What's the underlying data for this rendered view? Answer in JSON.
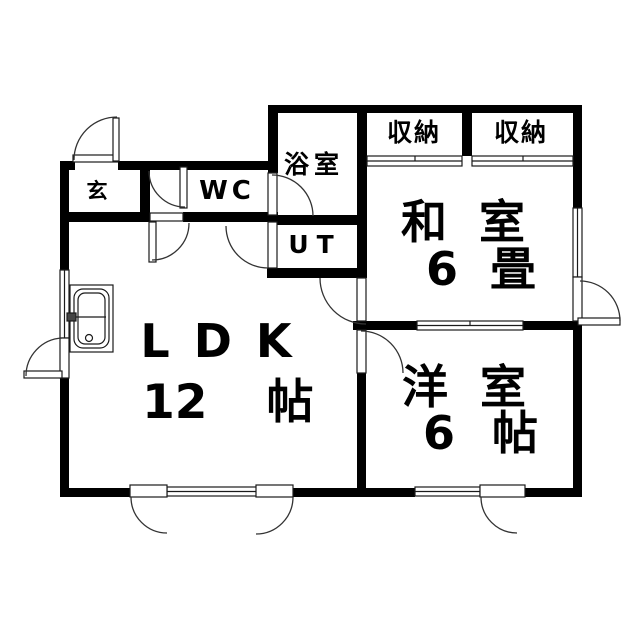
{
  "colors": {
    "wall": "#000000",
    "line": "#1a1a1a",
    "background": "#ffffff"
  },
  "rooms": {
    "genkan": {
      "label": "玄"
    },
    "wc": {
      "label": "WC"
    },
    "bath": {
      "label": "浴室"
    },
    "utility": {
      "label": "UT"
    },
    "closet_left": {
      "label": "収納"
    },
    "closet_right": {
      "label": "収納"
    },
    "washitsu": {
      "name": [
        "和",
        "室"
      ],
      "size": [
        "6",
        "畳"
      ]
    },
    "youshitsu": {
      "name": [
        "洋",
        "室"
      ],
      "size": [
        "6",
        "帖"
      ]
    },
    "ldk": {
      "name": "LDK",
      "size_number": "12",
      "size_unit": "帖"
    }
  }
}
